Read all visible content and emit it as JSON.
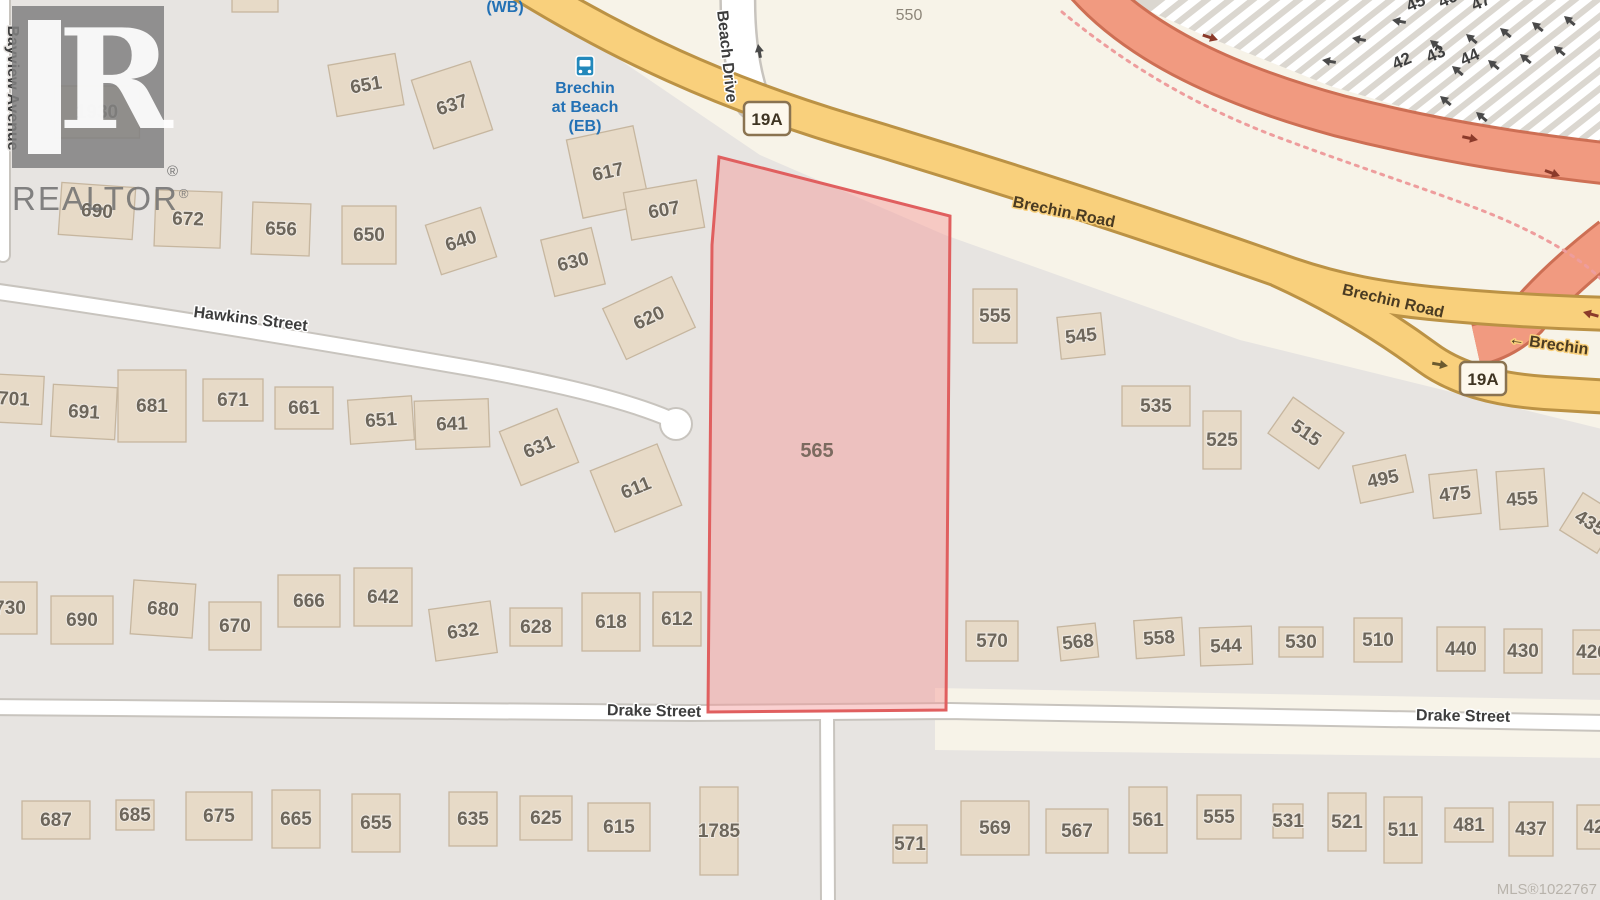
{
  "watermark": {
    "name": "REALTOR",
    "big_letter": "R",
    "reg": "®"
  },
  "mls": {
    "text": "MLS®1022767"
  },
  "map": {
    "colors": {
      "base": "#e7e4e1",
      "cream": "#f7f3e8",
      "ferry_bg": "#dbd7d0",
      "stripe": "#ffffff",
      "building": "#e7dac7",
      "building_line": "#c6b69f",
      "house_text": "#6d665b",
      "road_white": "#ffffff",
      "road_casing": "#c8c4be",
      "primary": "#f9d07c",
      "primary_casing": "#bb9245",
      "trunk": "#f19a80",
      "trunk_casing": "#cd6f54",
      "parcel_fill": "rgba(243,150,150,0.45)",
      "parcel_line": "#e05f5f",
      "parcel_text": "#7b6a5f",
      "label_dark": "#3d3d3d",
      "brechin_text": "#4a3b22",
      "transit_blue": "#2371b5",
      "bus_fill": "#2288bb",
      "shield_fill": "#fdf8ec",
      "shield_line": "#8a7350",
      "shield_text": "#3f3523",
      "dotted": "#ee9d9d",
      "arrow_dark": "#4a4a4a",
      "arrow_red": "#8b3a2a",
      "ferry_num": "#3f3f3f",
      "area_label": "#8d8679"
    },
    "areas": {
      "cream_north": "530,0 1606,0 1606,430 1240,340 945,235 760,155 620,60",
      "cream_drake": "935,688 1606,700 1606,758 935,750",
      "ferry": "1125,0 1606,0 1606,152 1480,130 1330,86 1205,36"
    },
    "roads": [
      {
        "name": "bayview-avenue",
        "d": "M 3,-6 L 3,255",
        "w": 12,
        "c": 16
      },
      {
        "name": "beach-drive",
        "d": "M 738,-12 C 737,30 741,68 753,102",
        "w": 32,
        "c": 37
      },
      {
        "name": "hawkins-street",
        "d": "M -8,291 C 140,312 320,342 470,368 C 560,384 628,401 670,419",
        "w": 14,
        "c": 18
      },
      {
        "name": "drake-street",
        "d": "M -8,707 L 690,713 L 950,711 L 1606,723",
        "w": 14,
        "c": 18
      },
      {
        "name": "drake-side-street",
        "d": "M 827,714 L 828,906",
        "w": 12,
        "c": 16
      }
    ],
    "culdesac": {
      "x": 676,
      "y": 424,
      "r": 15
    },
    "trunk_roads": [
      {
        "name": "terminal-road",
        "d": "M 1086,-16 C 1140,45 1230,86 1340,116 C 1450,144 1540,156 1612,164"
      },
      {
        "name": "terminal-merge-ramp",
        "d": "M 1612,238 C 1576,266 1546,294 1526,318 C 1510,333 1494,341 1476,345"
      }
    ],
    "primary_roads": [
      {
        "name": "brechin-road-main",
        "d": "M 521,-16 C 620,45 720,92 850,131 C 1000,176 1160,228 1290,274 C 1340,291 1382,298 1430,303 C 1490,309 1545,312 1612,314"
      },
      {
        "name": "brechin-road-branch",
        "d": "M 1278,270 C 1340,298 1390,330 1428,358 C 1458,380 1500,390 1545,393 L 1612,397"
      }
    ],
    "dotted_path": "M 1062,12 C 1130,68 1200,108 1280,138 C 1380,175 1460,200 1505,220 C 1555,242 1585,262 1606,284",
    "parcel": {
      "label": "565",
      "points": "719,157 950,216 946,710 708,712 712,245",
      "lx": 817,
      "ly": 457
    },
    "houses": [
      [
        "1930",
        97,
        112,
        85,
        52,
        0
      ],
      [
        "",
        255,
        4,
        46,
        16,
        0
      ],
      [
        "651",
        366,
        85,
        68,
        52,
        -10
      ],
      [
        "637",
        452,
        105,
        62,
        72,
        -18
      ],
      [
        "617",
        608,
        172,
        68,
        80,
        -12
      ],
      [
        "607",
        664,
        210,
        74,
        48,
        -10
      ],
      [
        "690",
        97,
        211,
        74,
        52,
        4
      ],
      [
        "672",
        188,
        219,
        66,
        56,
        2
      ],
      [
        "656",
        281,
        229,
        58,
        52,
        2
      ],
      [
        "650",
        369,
        235,
        54,
        58,
        0
      ],
      [
        "640",
        461,
        241,
        58,
        52,
        -18
      ],
      [
        "630",
        573,
        262,
        52,
        58,
        -14
      ],
      [
        "620",
        649,
        318,
        76,
        56,
        -25
      ],
      [
        "701",
        14,
        399,
        58,
        48,
        3
      ],
      [
        "691",
        84,
        412,
        64,
        52,
        3
      ],
      [
        "681",
        152,
        406,
        68,
        72,
        0
      ],
      [
        "671",
        233,
        400,
        60,
        42,
        0
      ],
      [
        "661",
        304,
        408,
        58,
        42,
        0
      ],
      [
        "651",
        381,
        420,
        64,
        44,
        -4
      ],
      [
        "641",
        452,
        424,
        74,
        48,
        -2
      ],
      [
        "631",
        539,
        447,
        62,
        58,
        -22
      ],
      [
        "611",
        636,
        488,
        72,
        66,
        -22
      ],
      [
        "730",
        10,
        608,
        54,
        52,
        0
      ],
      [
        "690",
        82,
        620,
        62,
        48,
        0
      ],
      [
        "680",
        163,
        609,
        62,
        54,
        4
      ],
      [
        "670",
        235,
        626,
        52,
        48,
        0
      ],
      [
        "666",
        309,
        601,
        62,
        52,
        0
      ],
      [
        "642",
        383,
        597,
        58,
        58,
        0
      ],
      [
        "632",
        463,
        631,
        62,
        52,
        -8
      ],
      [
        "628",
        536,
        627,
        52,
        38,
        0
      ],
      [
        "618",
        611,
        622,
        58,
        58,
        0
      ],
      [
        "612",
        677,
        619,
        48,
        54,
        0
      ],
      [
        "555",
        995,
        316,
        44,
        54,
        0
      ],
      [
        "545",
        1081,
        336,
        44,
        42,
        -6
      ],
      [
        "535",
        1156,
        406,
        68,
        40,
        0
      ],
      [
        "525",
        1222,
        440,
        38,
        58,
        0
      ],
      [
        "515",
        1306,
        433,
        62,
        44,
        35
      ],
      [
        "495",
        1383,
        479,
        54,
        38,
        -12
      ],
      [
        "475",
        1455,
        494,
        48,
        44,
        -6
      ],
      [
        "455",
        1522,
        499,
        48,
        58,
        -4
      ],
      [
        "435",
        1590,
        523,
        44,
        44,
        32
      ],
      [
        "570",
        992,
        641,
        52,
        40,
        0
      ],
      [
        "568",
        1078,
        642,
        38,
        34,
        -6
      ],
      [
        "558",
        1159,
        638,
        48,
        38,
        -4
      ],
      [
        "544",
        1226,
        646,
        52,
        38,
        -2
      ],
      [
        "530",
        1301,
        642,
        44,
        30,
        0
      ],
      [
        "510",
        1378,
        640,
        48,
        44,
        0
      ],
      [
        "440",
        1461,
        649,
        48,
        44,
        0
      ],
      [
        "430",
        1523,
        651,
        38,
        44,
        0
      ],
      [
        "426",
        1592,
        652,
        38,
        44,
        0
      ],
      [
        "687",
        56,
        820,
        68,
        38,
        0
      ],
      [
        "685",
        135,
        815,
        38,
        30,
        0
      ],
      [
        "675",
        219,
        816,
        66,
        48,
        0
      ],
      [
        "665",
        296,
        819,
        48,
        58,
        0
      ],
      [
        "655",
        376,
        823,
        48,
        58,
        0
      ],
      [
        "635",
        473,
        819,
        48,
        54,
        0
      ],
      [
        "625",
        546,
        818,
        52,
        44,
        0
      ],
      [
        "615",
        619,
        827,
        62,
        48,
        0
      ],
      [
        "1785",
        719,
        831,
        38,
        88,
        0
      ],
      [
        "571",
        910,
        844,
        34,
        38,
        0
      ],
      [
        "569",
        995,
        828,
        68,
        54,
        0
      ],
      [
        "567",
        1077,
        831,
        62,
        44,
        0
      ],
      [
        "561",
        1148,
        820,
        38,
        66,
        0
      ],
      [
        "555",
        1219,
        817,
        44,
        44,
        0
      ],
      [
        "531",
        1288,
        821,
        30,
        34,
        0
      ],
      [
        "521",
        1347,
        822,
        38,
        58,
        0
      ],
      [
        "511",
        1403,
        830,
        38,
        66,
        0
      ],
      [
        "481",
        1469,
        825,
        48,
        34,
        0
      ],
      [
        "437",
        1531,
        829,
        44,
        54,
        0
      ],
      [
        "42",
        1594,
        827,
        34,
        44,
        0
      ]
    ],
    "street_labels": [
      [
        "Bayview Avenue",
        8,
        88,
        90,
        "gray"
      ],
      [
        "Beach Drive",
        722,
        57,
        84,
        "white"
      ],
      [
        "Hawkins Street",
        250,
        324,
        7,
        "white"
      ],
      [
        "Drake Street",
        654,
        716,
        1,
        "white"
      ],
      [
        "Drake Street",
        1463,
        721,
        1,
        "white"
      ],
      [
        "Brechin Road",
        1063,
        217,
        11.5,
        "yellow"
      ],
      [
        "Brechin Road",
        1392,
        306,
        13,
        "yellow"
      ],
      [
        "← Brechin",
        1548,
        349,
        8,
        "yellow"
      ]
    ],
    "shields": [
      {
        "t": "19A",
        "x": 767,
        "y": 119
      },
      {
        "t": "19A",
        "x": 1483,
        "y": 379
      }
    ],
    "area_labels": [
      {
        "t": "550",
        "x": 909,
        "y": 20
      }
    ],
    "transit": {
      "wb": {
        "t": "(WB)",
        "x": 505,
        "y": 12
      },
      "stop_lines": [
        "Brechin",
        "at Beach",
        "(EB)"
      ],
      "x": 585,
      "ys": [
        93,
        112,
        131
      ],
      "icon": {
        "x": 585,
        "y": 66
      }
    },
    "ferry": {
      "numbers": [
        [
          "42",
          1404,
          66
        ],
        [
          "43",
          1438,
          59
        ],
        [
          "44",
          1472,
          62
        ],
        [
          "45",
          1418,
          8
        ],
        [
          "46",
          1450,
          4
        ],
        [
          "47",
          1483,
          7
        ]
      ],
      "num_rot": -24,
      "arrows": [
        [
          1392,
          20,
          -170
        ],
        [
          1352,
          38,
          -170
        ],
        [
          1322,
          60,
          -170
        ],
        [
          1430,
          40,
          -140
        ],
        [
          1466,
          34,
          -140
        ],
        [
          1500,
          28,
          -140
        ],
        [
          1532,
          22,
          -140
        ],
        [
          1564,
          16,
          -140
        ],
        [
          1452,
          66,
          -140
        ],
        [
          1488,
          60,
          -140
        ],
        [
          1520,
          54,
          -140
        ],
        [
          1554,
          46,
          -140
        ],
        [
          1440,
          96,
          -140
        ],
        [
          1476,
          112,
          -140
        ]
      ]
    },
    "road_arrows": {
      "trunk": [
        [
          1218,
          40,
          18
        ],
        [
          1478,
          140,
          12
        ],
        [
          1560,
          176,
          20
        ]
      ],
      "merge": [
        [
          1583,
          312,
          -165
        ]
      ],
      "primary": [
        [
          1448,
          366,
          10
        ]
      ],
      "beach": [
        [
          758,
          44,
          -100
        ]
      ]
    }
  }
}
